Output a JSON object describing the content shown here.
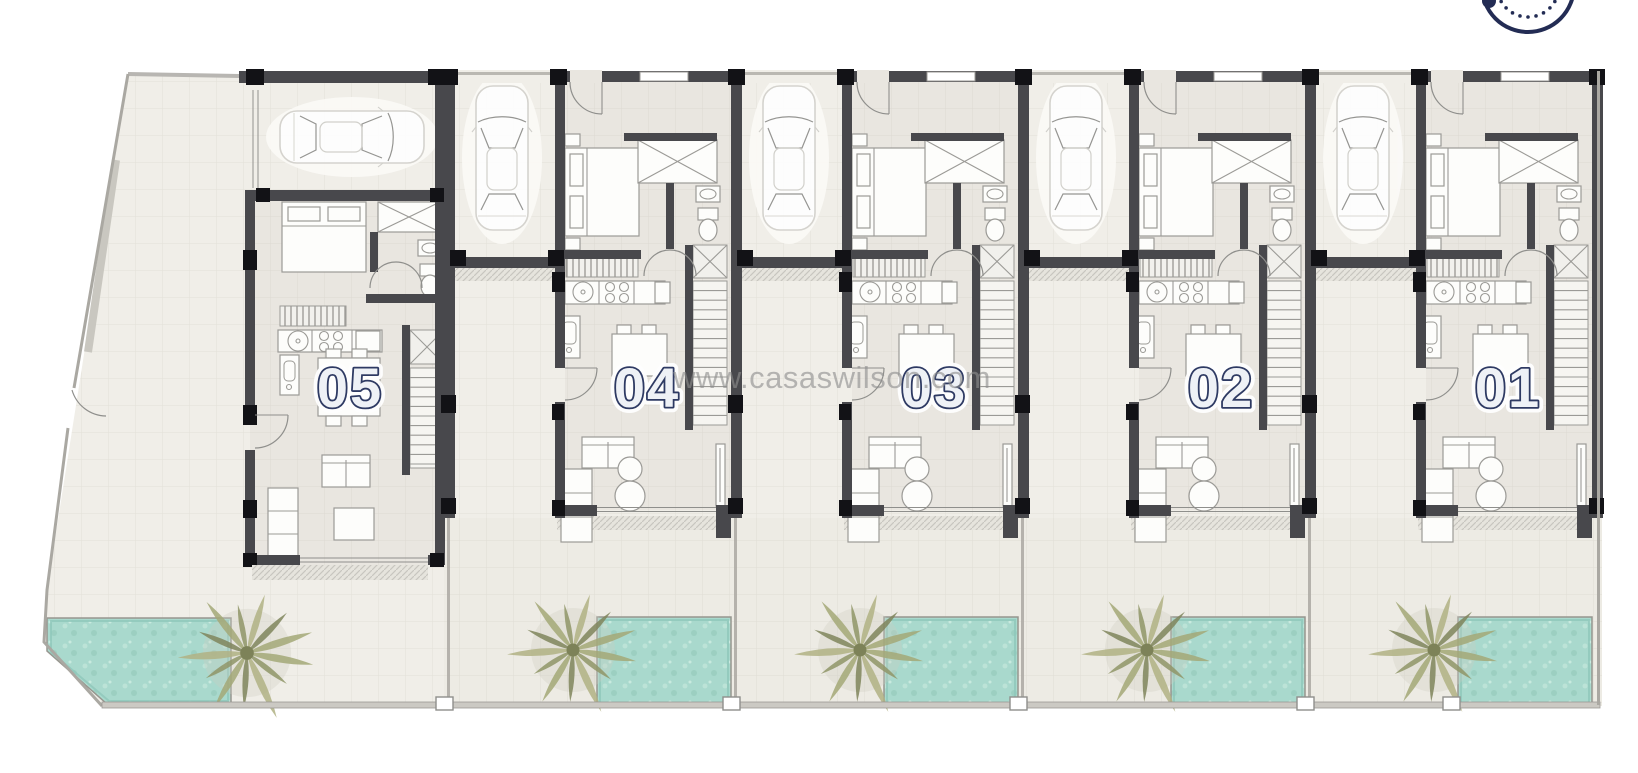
{
  "page": {
    "background": "#ffffff",
    "description": "Architectural ground-floor site plan of five attached townhouse units with carports, private pools and palm trees"
  },
  "watermark": {
    "text": "www.casaswilson.com"
  },
  "brand_logo": {
    "name": "circular-logo-partial",
    "color": "#232c54"
  },
  "units": [
    {
      "id": "unit-05",
      "label": "05",
      "type": "A",
      "x": 240,
      "pool": true,
      "palm_tree": true,
      "car": true
    },
    {
      "id": "unit-04",
      "label": "04",
      "type": "B",
      "x": 444,
      "pool": true,
      "palm_tree": true,
      "car": true
    },
    {
      "id": "unit-03",
      "label": "03",
      "type": "B",
      "x": 731,
      "pool": true,
      "palm_tree": true,
      "car": true
    },
    {
      "id": "unit-02",
      "label": "02",
      "type": "B",
      "x": 1018,
      "pool": true,
      "palm_tree": true,
      "car": true
    },
    {
      "id": "unit-01",
      "label": "01",
      "type": "B",
      "x": 1305,
      "pool": true,
      "palm_tree": true,
      "car": true
    }
  ],
  "icons": {
    "car": "car-icon",
    "palm": "palm-tree-icon",
    "pool": "swimming-pool",
    "stairs": "staircase",
    "logo": "brand-logo-partial"
  },
  "colors": {
    "wall": "#48484c",
    "pillar": "#121216",
    "floor_interior": "#e9e6e0",
    "floor_walkway": "#f0eee8",
    "floor_yard": "#edebe4",
    "pool": "#a9d9cd",
    "pool_edge": "#8fc7ba",
    "palm": "#9aa271",
    "label_fill": "#eef1f6",
    "label_outline": "#2e3a63",
    "watermark": "#8e8e8e",
    "boundary": "#aaa8a2",
    "furniture_stroke": "#9b9a96",
    "logo_navy": "#232c54"
  }
}
